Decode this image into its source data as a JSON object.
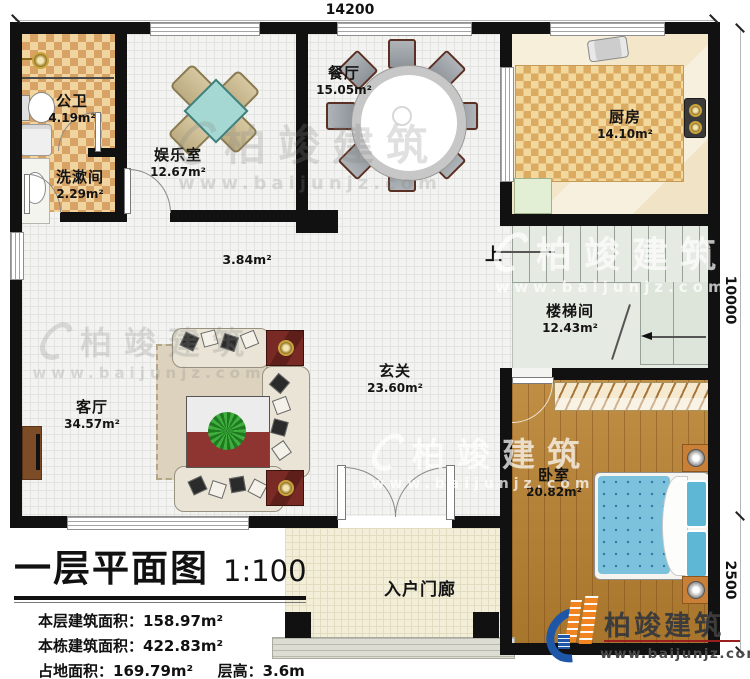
{
  "title_block": {
    "title": "一层平面图",
    "scale": "1:100",
    "stats": [
      {
        "label": "本层建筑面积：",
        "value": "158.97m²"
      },
      {
        "label": "本栋建筑面积：",
        "value": "422.83m²"
      },
      {
        "label": "占地面积：",
        "value": "169.79m²",
        "label2": "层高：",
        "value2": "3.6m"
      }
    ]
  },
  "dimensions": {
    "top": "14200",
    "right_upper": "10000",
    "right_lower": "2500"
  },
  "rooms": [
    {
      "name": "公卫",
      "area": "4.19m²"
    },
    {
      "name": "洗漱间",
      "area": "2.29m²"
    },
    {
      "name": "娱乐室",
      "area": "12.67m²"
    },
    {
      "name": "餐厅",
      "area": "15.05m²"
    },
    {
      "name": "厨房",
      "area": "14.10m²"
    },
    {
      "name": "楼梯间",
      "area": "12.43m²"
    },
    {
      "name": "玄关",
      "area": "23.60m²"
    },
    {
      "name": "客厅",
      "area": "34.57m²"
    },
    {
      "name": "卧室",
      "area": "20.82m²"
    },
    {
      "name": "入户门廊",
      "area": ""
    }
  ],
  "annotations": {
    "column_area": "3.84m²",
    "stairs_up": "上"
  },
  "branding": {
    "company": "柏竣建筑",
    "website": "www.baijunjz.com"
  },
  "watermark": {
    "company": "柏竣建筑",
    "website": "www.baijunjz.com"
  },
  "colors": {
    "wall": "#111111",
    "checker_tile": "#d8a264",
    "wood_floor": "#b9812f",
    "bed": "#7cc2dd",
    "logo_blue": "#1e56a8",
    "logo_orange": "#f08420"
  }
}
